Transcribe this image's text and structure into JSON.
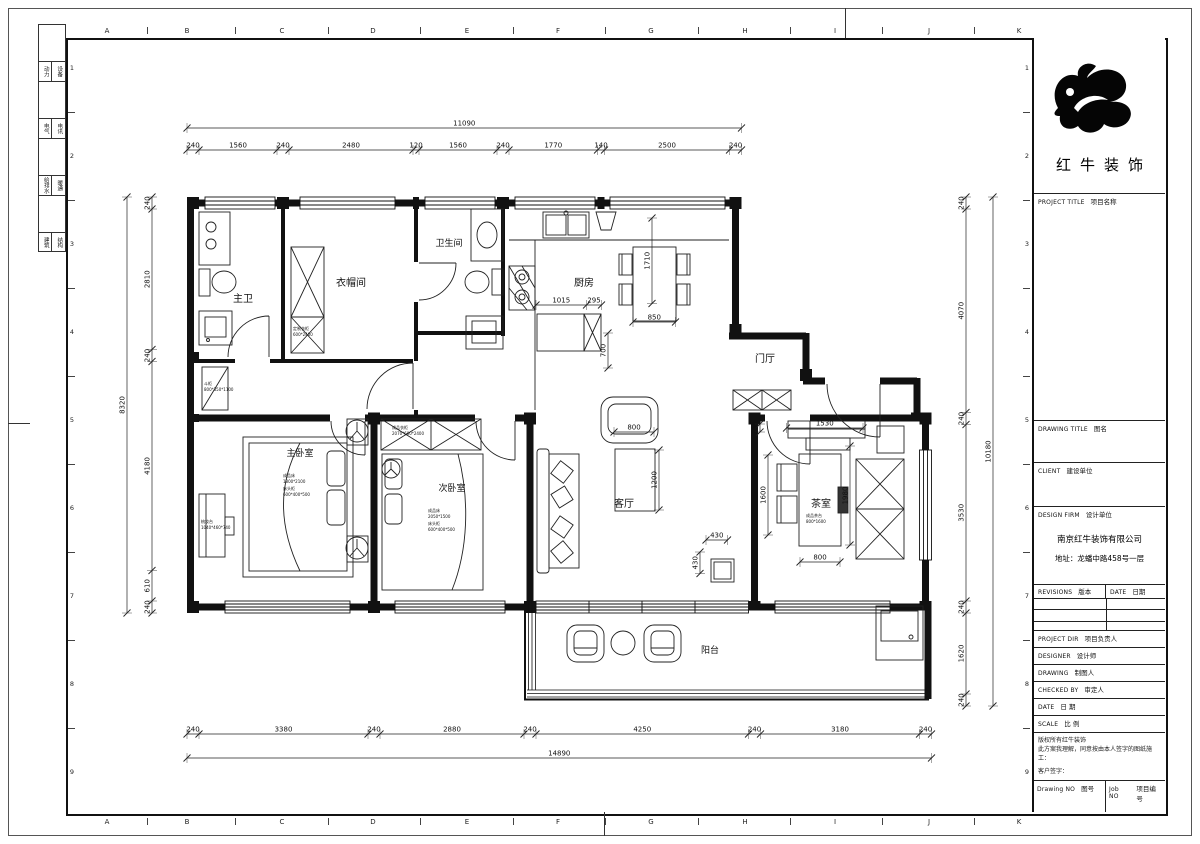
{
  "sheet": {
    "grid_letters": [
      "A",
      "B",
      "C",
      "D",
      "E",
      "F",
      "G",
      "H",
      "I",
      "J",
      "K"
    ],
    "grid_letter_x": [
      107,
      187,
      282,
      373,
      467,
      558,
      651,
      745,
      835,
      929,
      1019
    ],
    "grid_numbers": [
      "1",
      "2",
      "3",
      "4",
      "5",
      "6",
      "7",
      "8",
      "9"
    ],
    "grid_number_y": [
      68,
      156,
      244,
      332,
      420,
      508,
      596,
      684,
      772
    ],
    "disciplines": [
      [
        "动力",
        "设备"
      ],
      [
        "电气",
        "电讯"
      ],
      [
        "给排水",
        "暖通"
      ],
      [
        "建筑",
        "结构"
      ]
    ]
  },
  "titleblock": {
    "brand": "红牛装饰",
    "project_title": {
      "en": "PROJECT TITLE",
      "zh": "项目名称"
    },
    "drawing_title": {
      "en": "DRAWING TITLE",
      "zh": "图名"
    },
    "client": {
      "en": "CLIENT",
      "zh": "建设单位"
    },
    "design_firm": {
      "en": "DESIGN FIRM",
      "zh": "设计单位"
    },
    "company": "南京红牛装饰有限公司",
    "address": "地址：龙蟠中路458号一层",
    "revisions": {
      "en": "REVISIONS",
      "zh": "版本"
    },
    "date_col": {
      "en": "DATE",
      "zh": "日期"
    },
    "project_dir": {
      "en": "PROJECT DIR",
      "zh": "项目负责人"
    },
    "designer": {
      "en": "DESIGNER",
      "zh": "设计师"
    },
    "drawing": {
      "en": "DRAWING",
      "zh": "制图人"
    },
    "checked_by": {
      "en": "CHECKED BY",
      "zh": "审定人"
    },
    "date_row": {
      "en": "DATE",
      "zh": "日 期"
    },
    "scale": {
      "en": "SCALE",
      "zh": "比 例"
    },
    "copyright_line1": "版权所有红牛装饰",
    "copyright_line2": "此方案我理解，同意按由本人签字的图纸施工：",
    "customer_sign": "客户签字：",
    "drawing_no": {
      "en": "Drawing NO",
      "zh": "图号"
    },
    "job_no": {
      "en": "Job NO",
      "zh": "项目编号"
    }
  },
  "plan": {
    "labels": [
      {
        "t": "主卫",
        "x": 243,
        "y": 302,
        "s": 10
      },
      {
        "t": "衣帽间",
        "x": 351,
        "y": 286,
        "s": 10
      },
      {
        "t": "卫生间",
        "x": 449,
        "y": 246,
        "s": 9
      },
      {
        "t": "厨房",
        "x": 584,
        "y": 286,
        "s": 10
      },
      {
        "t": "门厅",
        "x": 765,
        "y": 362,
        "s": 10
      },
      {
        "t": "主卧室",
        "x": 300,
        "y": 456,
        "s": 9
      },
      {
        "t": "次卧室",
        "x": 452,
        "y": 491,
        "s": 9
      },
      {
        "t": "客厅",
        "x": 624,
        "y": 507,
        "s": 10
      },
      {
        "t": "茶室",
        "x": 821,
        "y": 507,
        "s": 10
      },
      {
        "t": "阳台",
        "x": 710,
        "y": 653,
        "s": 9
      },
      {
        "t": "成品床",
        "x": 283,
        "y": 477,
        "s": 4,
        "a": "start"
      },
      {
        "t": "1800*2100",
        "x": 283,
        "y": 483,
        "s": 4,
        "a": "start"
      },
      {
        "t": "床头柜",
        "x": 283,
        "y": 490,
        "s": 4,
        "a": "start"
      },
      {
        "t": "600*400*500",
        "x": 283,
        "y": 496,
        "s": 4,
        "a": "start"
      },
      {
        "t": "成品床",
        "x": 428,
        "y": 512,
        "s": 4,
        "a": "start"
      },
      {
        "t": "2050*1500",
        "x": 428,
        "y": 518,
        "s": 4,
        "a": "start"
      },
      {
        "t": "床头柜",
        "x": 428,
        "y": 525,
        "s": 4,
        "a": "start"
      },
      {
        "t": "600*400*500",
        "x": 428,
        "y": 531,
        "s": 4,
        "a": "start"
      },
      {
        "t": "成品衣柜",
        "x": 392,
        "y": 429,
        "s": 4,
        "a": "start"
      },
      {
        "t": "2070*600*2400",
        "x": 392,
        "y": 435,
        "s": 4,
        "a": "start"
      },
      {
        "t": "定制衣柜",
        "x": 293,
        "y": 330,
        "s": 4,
        "a": "start"
      },
      {
        "t": "600*2400",
        "x": 293,
        "y": 336,
        "s": 4,
        "a": "start"
      },
      {
        "t": "梳妆台",
        "x": 201,
        "y": 523,
        "s": 4,
        "a": "start"
      },
      {
        "t": "1040*460*740",
        "x": 201,
        "y": 529,
        "s": 4,
        "a": "start"
      },
      {
        "t": "斗柜",
        "x": 204,
        "y": 385,
        "s": 4,
        "a": "start"
      },
      {
        "t": "800*350*1100",
        "x": 204,
        "y": 391,
        "s": 4,
        "a": "start"
      },
      {
        "t": "成品茶台",
        "x": 806,
        "y": 517,
        "s": 4,
        "a": "start"
      },
      {
        "t": "800*1600",
        "x": 806,
        "y": 523,
        "s": 4,
        "a": "start"
      }
    ],
    "dims": [
      {
        "o": "h",
        "p": 128,
        "t": [
          187,
          741.5
        ],
        "v": [
          "11090"
        ]
      },
      {
        "o": "h",
        "p": 150,
        "t": [
          187,
          199,
          277,
          289,
          413,
          419,
          497,
          509,
          597.5,
          604.5,
          729.5,
          741.5
        ],
        "v": [
          "240",
          "1560",
          "240",
          "2480",
          "120",
          "1560",
          "240",
          "1770",
          "140",
          "2500",
          "240"
        ]
      },
      {
        "o": "h",
        "p": 734,
        "t": [
          187,
          199,
          368,
          380,
          524,
          536,
          748.5,
          760.5,
          919.5,
          931.5
        ],
        "v": [
          "240",
          "3380",
          "240",
          "2880",
          "240",
          "4250",
          "240",
          "3180",
          "240"
        ]
      },
      {
        "o": "h",
        "p": 758,
        "t": [
          187,
          931.5
        ],
        "v": [
          "14890"
        ]
      },
      {
        "o": "v",
        "p": 127,
        "t": [
          197,
          613
        ],
        "v": [
          "8320"
        ]
      },
      {
        "o": "v",
        "p": 152,
        "t": [
          197,
          209,
          349.5,
          361.5,
          570.5,
          601,
          613
        ],
        "v": [
          "240",
          "2810",
          "240",
          "4180",
          "610",
          "240"
        ]
      },
      {
        "o": "v",
        "p": 966,
        "t": [
          197,
          209,
          412.5,
          424.5,
          601,
          613,
          694,
          706
        ],
        "v": [
          "240",
          "4070",
          "240",
          "3530",
          "240",
          "1620",
          "240"
        ]
      },
      {
        "o": "v",
        "p": 993,
        "t": [
          197,
          706
        ],
        "v": [
          "10180"
        ]
      },
      {
        "o": "h",
        "p": 305,
        "t": [
          536,
          586.5,
          601.5
        ],
        "v": [
          "1015",
          "295"
        ]
      },
      {
        "o": "v",
        "p": 608,
        "t": [
          333,
          368
        ],
        "v": [
          "700"
        ]
      },
      {
        "o": "v",
        "p": 652,
        "t": [
          218,
          303.5
        ],
        "v": [
          "1710"
        ]
      },
      {
        "o": "h",
        "p": 322,
        "t": [
          633,
          675.5
        ],
        "v": [
          "850"
        ]
      },
      {
        "o": "h",
        "p": 432,
        "t": [
          614,
          654
        ],
        "v": [
          "800"
        ]
      },
      {
        "o": "v",
        "p": 659,
        "t": [
          450,
          510
        ],
        "v": [
          "1200"
        ]
      },
      {
        "o": "h",
        "p": 540,
        "t": [
          706,
          727.5
        ],
        "v": [
          "430"
        ]
      },
      {
        "o": "v",
        "p": 700,
        "t": [
          552,
          573.5
        ],
        "v": [
          "430"
        ]
      },
      {
        "o": "v",
        "p": 760,
        "t": [
          424,
          432
        ],
        "v": [
          "160"
        ]
      },
      {
        "o": "h",
        "p": 428,
        "t": [
          786.5,
          863
        ],
        "v": [
          "1530"
        ]
      },
      {
        "o": "v",
        "p": 768,
        "t": [
          455,
          535
        ],
        "v": [
          "1600"
        ]
      },
      {
        "o": "v",
        "p": 850,
        "t": [
          446,
          545
        ],
        "v": [
          "1980"
        ]
      },
      {
        "o": "h",
        "p": 562,
        "t": [
          800,
          840
        ],
        "v": [
          "800"
        ]
      }
    ]
  }
}
